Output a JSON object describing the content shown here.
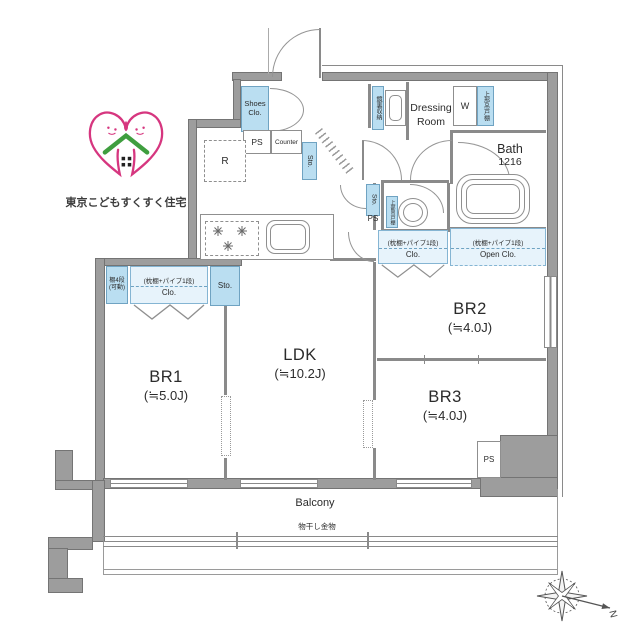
{
  "logo": {
    "title": "東京こどもすくすく住宅"
  },
  "rooms": {
    "br1": {
      "name": "BR1",
      "size": "(≒5.0J)"
    },
    "ldk": {
      "name": "LDK",
      "size": "(≒10.2J)"
    },
    "br2": {
      "name": "BR2",
      "size": "(≒4.0J)"
    },
    "br3": {
      "name": "BR3",
      "size": "(≒4.0J)"
    },
    "dressing_room": {
      "name": "Dressing Room"
    },
    "bath": {
      "name": "Bath",
      "size": "1216"
    },
    "balcony": {
      "name": "Balcony"
    }
  },
  "labels": {
    "shoes_closet": "Shoes Clo.",
    "ps": "PS",
    "counter": "Counter",
    "refrigerator": "R",
    "storage": "Sto.",
    "washer": "W",
    "upper_cabinet": "上部吊戸棚",
    "mirror_cabinet": "鏡裏収納",
    "movable_shelf": "棚4段(可動)",
    "closet_spec": "(枕棚+パイプ1段)",
    "closet": "Clo.",
    "open_closet": "Open Clo.",
    "drying_fixture": "物干し金物",
    "north": "N"
  },
  "colors": {
    "wall_gray": "#9d9d9d",
    "line_gray": "#8a8a8a",
    "fixture_blue": "#badef1",
    "closet_blue": "#e7f3fb",
    "logo_pink": "#d6367f",
    "logo_green": "#3f9e3f"
  }
}
